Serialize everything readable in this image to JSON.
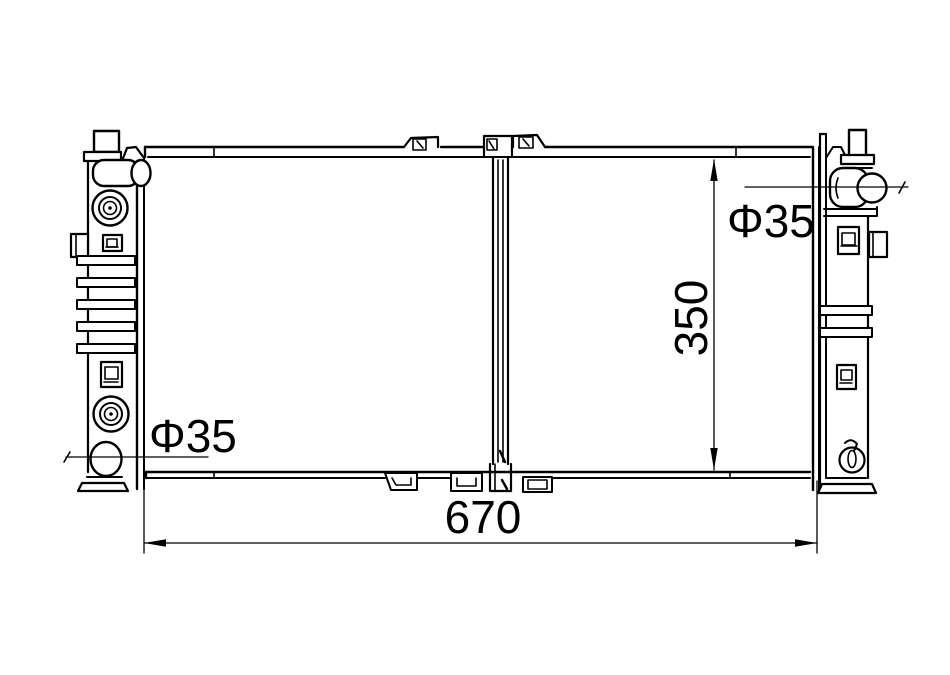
{
  "drawing": {
    "type": "engineering-line-drawing",
    "background_color": "#ffffff",
    "line_color": "#000000",
    "labels": {
      "overall_width": "670",
      "core_height": "350",
      "left_outlet_diameter": "Φ35",
      "right_inlet_diameter": "Φ35"
    }
  }
}
